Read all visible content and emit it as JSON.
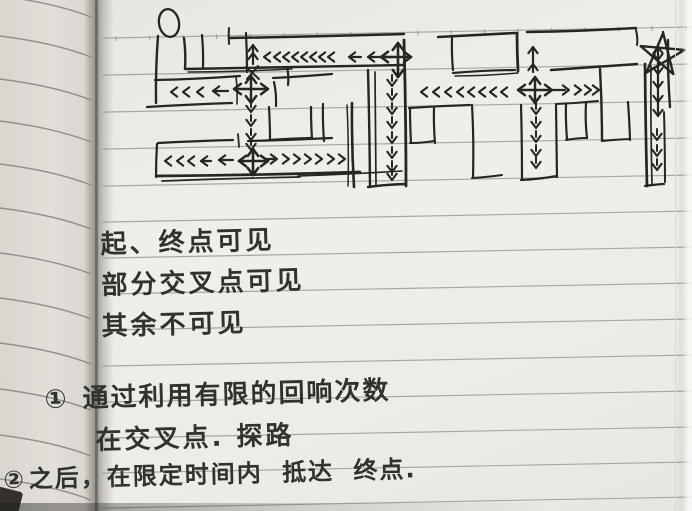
{
  "photo": {
    "kind": "handwritten notebook page photo",
    "paper_color": "#edebe6",
    "ink_color": "#272520",
    "ruled_line_color": "#a2a09a"
  },
  "notes": {
    "visibility": [
      "起、终点可见",
      "部分交叉点可见",
      "其余不可见"
    ],
    "items": [
      {
        "bullet": "①",
        "lines": [
          "通过利用有限的回响次数",
          "在交叉点. 探路"
        ]
      },
      {
        "bullet": "②",
        "lines": [
          "之后，在限定时间内 抵达 终点."
        ]
      }
    ]
  },
  "maze": {
    "start_marker": "oval",
    "goal_marker": "star",
    "ink": "#272520",
    "oval": {
      "cx": 169,
      "cy": 23,
      "rx": 10,
      "ry": 14,
      "rot": -10
    },
    "star": {
      "cx": 662,
      "cy": 54,
      "path": "M661,32 L675,73 L640,48 L684,48 L648,74 L661,34"
    },
    "walls": [
      [
        158,
        36,
        156,
        103,
        2.4
      ],
      [
        184,
        38,
        185,
        69,
        2.4
      ],
      [
        202,
        35,
        203,
        67,
        2.2
      ],
      [
        246,
        33,
        247,
        72,
        2.2
      ],
      [
        229,
        38,
        404,
        34,
        2.5
      ],
      [
        229,
        28,
        229,
        44,
        2.0
      ],
      [
        186,
        69,
        404,
        65,
        2.4
      ],
      [
        188,
        72,
        292,
        69,
        1.5
      ],
      [
        287,
        67,
        288,
        85,
        2.2
      ],
      [
        404,
        40,
        406,
        186,
        2.8
      ],
      [
        368,
        70,
        370,
        187,
        2.4
      ],
      [
        375,
        72,
        376,
        186,
        1.7
      ],
      [
        155,
        80,
        240,
        76,
        2.2
      ],
      [
        147,
        107,
        232,
        103,
        2.2
      ],
      [
        273,
        78,
        332,
        74,
        2.2
      ],
      [
        274,
        82,
        276,
        106,
        2.2
      ],
      [
        236,
        76,
        237,
        104,
        1.6
      ],
      [
        269,
        107,
        270,
        140,
        2.2
      ],
      [
        269,
        140,
        311,
        138,
        2.2
      ],
      [
        311,
        107,
        312,
        139,
        2.2
      ],
      [
        323,
        104,
        324,
        141,
        2.2
      ],
      [
        352,
        103,
        354,
        187,
        2.6
      ],
      [
        347,
        105,
        348,
        186,
        1.5
      ],
      [
        158,
        143,
        233,
        140,
        2.2
      ],
      [
        248,
        141,
        332,
        138,
        2.2
      ],
      [
        238,
        134,
        239,
        147,
        1.8
      ],
      [
        157,
        144,
        156,
        177,
        2.2
      ],
      [
        157,
        176,
        360,
        172,
        2.7
      ],
      [
        162,
        181,
        300,
        177,
        1.7
      ],
      [
        298,
        176,
        402,
        171,
        1.6
      ],
      [
        368,
        187,
        406,
        184,
        2.4
      ],
      [
        438,
        37,
        515,
        33,
        2.5
      ],
      [
        527,
        32,
        636,
        28,
        2.5
      ],
      [
        517,
        33,
        518,
        71,
        2.8
      ],
      [
        452,
        38,
        453,
        70,
        2.2
      ],
      [
        453,
        73,
        515,
        70,
        2.2
      ],
      [
        551,
        70,
        637,
        64,
        2.5
      ],
      [
        455,
        76,
        518,
        73,
        1.4
      ],
      [
        409,
        108,
        470,
        105,
        2.2
      ],
      [
        556,
        104,
        598,
        101,
        2.0
      ],
      [
        410,
        108,
        411,
        143,
        2.2
      ],
      [
        434,
        108,
        435,
        143,
        2.2
      ],
      [
        410,
        143,
        434,
        141,
        2.0
      ],
      [
        472,
        105,
        473,
        177,
        2.2
      ],
      [
        472,
        178,
        502,
        175,
        2.0
      ],
      [
        521,
        105,
        522,
        178,
        2.2
      ],
      [
        556,
        105,
        557,
        177,
        2.2
      ],
      [
        521,
        180,
        557,
        176,
        2.3
      ],
      [
        566,
        104,
        567,
        139,
        2.2
      ],
      [
        586,
        103,
        587,
        138,
        2.2
      ],
      [
        566,
        140,
        587,
        138,
        2.0
      ],
      [
        600,
        69,
        602,
        141,
        2.4
      ],
      [
        628,
        102,
        630,
        140,
        2.2
      ],
      [
        602,
        141,
        630,
        139,
        2.0
      ],
      [
        645,
        64,
        647,
        186,
        2.7
      ],
      [
        651,
        66,
        652,
        184,
        1.7
      ],
      [
        668,
        40,
        670,
        107,
        2.4
      ],
      [
        636,
        30,
        637,
        45,
        2.0
      ],
      [
        645,
        186,
        664,
        184,
        2.2
      ],
      [
        664,
        112,
        665,
        182,
        2.0
      ]
    ],
    "crosses": [
      {
        "x": 398,
        "y": 57,
        "l": 381,
        "r": 411,
        "t": 43,
        "b": 77,
        "w": 2.6
      },
      {
        "x": 251,
        "y": 89,
        "l": 234,
        "r": 268,
        "t": 76,
        "b": 103,
        "w": 2.4
      },
      {
        "x": 253,
        "y": 161,
        "l": 239,
        "r": 268,
        "t": 149,
        "b": 175,
        "w": 2.6
      },
      {
        "x": 535,
        "y": 90,
        "l": 518,
        "r": 552,
        "t": 77,
        "b": 103,
        "w": 2.4
      }
    ],
    "chains": [
      {
        "dir": "left",
        "y": 57,
        "heads": [
          264,
          274,
          283,
          292,
          301,
          310,
          319,
          328
        ]
      },
      {
        "dir": "left",
        "y": 57,
        "heads": [
          349
        ],
        "shaft": [
          349,
          361
        ]
      },
      {
        "dir": "left",
        "y": 57,
        "heads": [
          368
        ],
        "shaft": [
          368,
          392
        ]
      },
      {
        "dir": "up",
        "x": 253,
        "heads": [
          45,
          53
        ],
        "shaft": [
          45,
          64
        ]
      },
      {
        "dir": "down",
        "x": 392,
        "heads": [
          86,
          100,
          114,
          128,
          143,
          158,
          172,
          180
        ]
      },
      {
        "dir": "left",
        "y": 92,
        "heads": [
          171,
          183,
          197
        ]
      },
      {
        "dir": "left",
        "y": 91,
        "heads": [
          213
        ],
        "shaft": [
          213,
          228
        ]
      },
      {
        "dir": "down",
        "x": 251,
        "heads": [
          112,
          126,
          140,
          150
        ]
      },
      {
        "dir": "left",
        "y": 161,
        "heads": [
          165,
          177,
          188
        ]
      },
      {
        "dir": "left",
        "y": 161,
        "heads": [
          201
        ],
        "shaft": [
          201,
          211
        ]
      },
      {
        "dir": "left",
        "y": 160,
        "heads": [
          219
        ],
        "shaft": [
          219,
          233
        ]
      },
      {
        "dir": "right",
        "y": 159,
        "heads": [
          277,
          289,
          300,
          311,
          322,
          334,
          345
        ],
        "shaft": [
          266,
          274
        ]
      },
      {
        "dir": "left",
        "y": 92,
        "heads": [
          421,
          433,
          445,
          457,
          468,
          479,
          490,
          501
        ]
      },
      {
        "dir": "up",
        "x": 533,
        "heads": [
          47,
          64
        ],
        "shaft": [
          47,
          72
        ]
      },
      {
        "dir": "right",
        "y": 90,
        "heads": [
          569,
          581,
          591,
          599
        ],
        "shaft": [
          553,
          565
        ]
      },
      {
        "dir": "down",
        "x": 536,
        "heads": [
          114,
          128,
          142,
          156,
          168
        ]
      },
      {
        "dir": "down",
        "x": 658,
        "heads": [
          60,
          74,
          88,
          102,
          116
        ],
        "shaft": [
          46,
          116
        ]
      },
      {
        "dir": "up",
        "x": 658,
        "heads": [
          47
        ]
      },
      {
        "dir": "down",
        "x": 657,
        "heads": [
          140,
          156,
          170
        ]
      }
    ],
    "scribbles": [
      [
        246,
        67,
        259,
        79,
        2.0
      ],
      [
        258,
        66,
        247,
        79,
        2.0
      ]
    ]
  }
}
